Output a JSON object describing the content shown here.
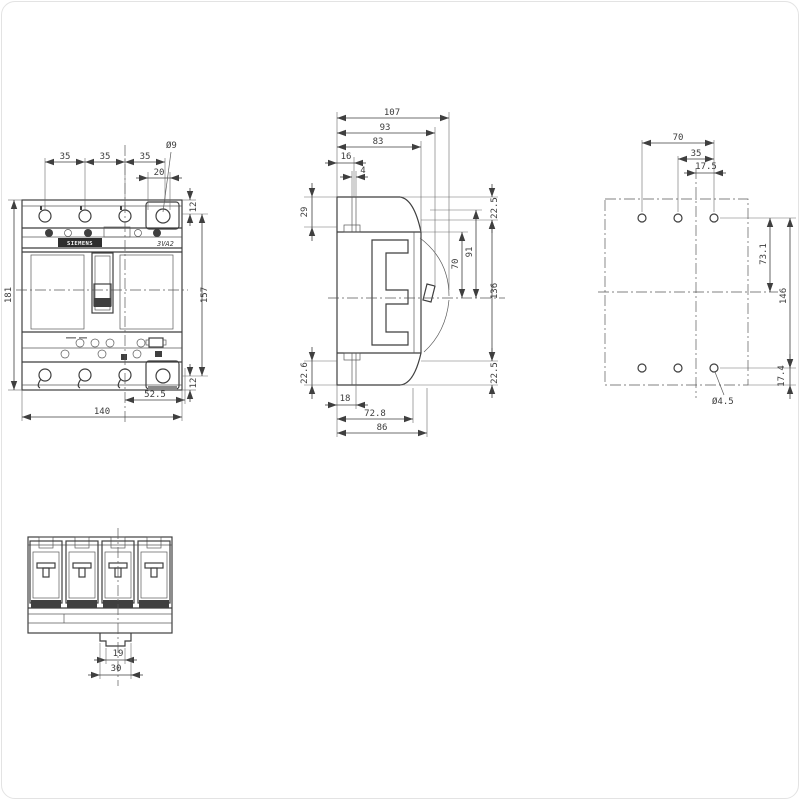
{
  "front_view": {
    "pitch_1": "35",
    "pitch_2": "35",
    "pitch_3": "35",
    "terminal_offset": "20",
    "terminal_hole_dia": "Ø9",
    "top_margin": "12",
    "body_height": "157",
    "bottom_margin": "12",
    "overall_height": "181",
    "center_to_edge": "52.5",
    "overall_width": "140",
    "brand": "SIEMENS",
    "model": "3VA2"
  },
  "side_view": {
    "depth_overall": "107",
    "depth_handle": "93",
    "depth_front": "83",
    "rail_offset": "16",
    "rail_gap": "4",
    "top_recess": "29",
    "bottom_recess": "22.6",
    "top_margin": "22.5",
    "body_height": "136",
    "bottom_margin": "22.5",
    "inner_height_a": "70",
    "inner_height_b": "91",
    "foot_depth": "18",
    "base_depth": "72.8",
    "mount_depth": "86"
  },
  "drilling_plan": {
    "hole_pitch_outer": "70",
    "hole_pitch": "35",
    "hole_half_pitch": "17.5",
    "center_to_holes": "73.1",
    "hole_row_span": "146",
    "bottom_offset": "17.4",
    "hole_dia": "Ø4.5"
  },
  "bottom_view": {
    "foot_notch_width": "19",
    "foot_width": "30"
  }
}
